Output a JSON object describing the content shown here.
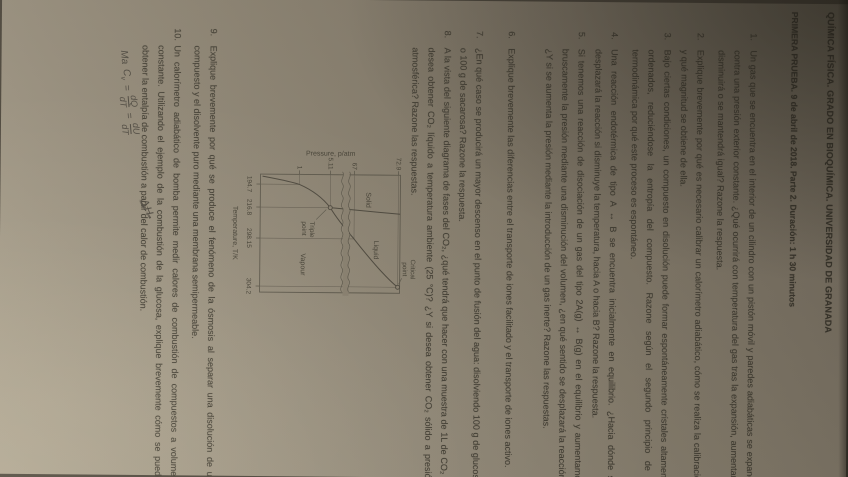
{
  "document": {
    "title": "QUÍMICA FÍSICA. GRADO EN BIOQUÍMICA. UNIVERSIDAD DE GRANADA",
    "subtitle": "PRIMERA PRUEBA. 9 de abril de 2018. Parte 2. Duración: 1 h 30 minutos"
  },
  "questions": [
    {
      "number": "1.",
      "text": "Un gas que se encuentra en el interior de un cilindro con un pistón móvil y paredes adiabáticas se expande contra una presión exterior constante. ¿Qué ocurrirá con temperatura del gas tras la expansión, aumentará, disminuirá o se mantendrá igual? Razone la respuesta."
    },
    {
      "number": "2.",
      "text": "Explique brevemente por qué es necesario calibrar un calorímetro adiabático, cómo se realiza la calibración y qué magnitud se obtiene de ella."
    },
    {
      "number": "3.",
      "text": "Bajo ciertas condiciones, un compuesto en disolución puede formar espontáneamente cristales altamente ordenados, reduciéndose la entropía del compuesto. Razone según el segundo principio de la termodinámica por qué este proceso es espontáneo."
    },
    {
      "number": "4.",
      "text": "Una reacción endotérmica de tipo A ↔ B se encuentra inicialmente en equilibrio. ¿Hacia dónde se desplazará la reacción si disminuye la temperatura, hacia A o hacia B? Razone la respuesta."
    },
    {
      "number": "5.",
      "text": "Si tenemos una reacción de disociación de un gas del tipo 2A(g) ↔ B(g) en el equilibrio y aumentamos bruscamente la presión mediante una disminución del volumen, ¿en qué sentido se desplazará la reacción? ¿Y si se aumenta la presión mediante la introducción de un gas inerte? Razone las respuestas."
    },
    {
      "number": "6.",
      "text": "Explique brevemente las diferencias entre el transporte de iones facilitado y el transporte de iones activo."
    },
    {
      "number": "7.",
      "text": "¿En qué caso se producirá un mayor descenso en el punto de fusión del agua: disolviendo 100 g de glucosa o 100 g de sacarosa? Razone la respuesta."
    },
    {
      "number": "8.",
      "text": "A la vista del siguiente diagrama de fases del CO₂, ¿qué tendrá que hacer con una muestra de 1L de CO₂ si desea obtener CO₂ líquido a temperatura ambiente (25 °C)? ¿Y si desea obtener CO₂ sólido a presión atmosférica? Razone las respuestas."
    },
    {
      "number": "9.",
      "text": "Explique brevemente por qué se produce el fenómeno de la ósmosis al separar una disolución de un compuesto y el disolvente puro mediante una membrana semipermeable."
    },
    {
      "number": "10.",
      "text": "Un calorímetro adiabático de bomba permite medir calores de combustión de compuestos a volumen constante. Utilizando el ejemplo de la combustión de la glucosa, explique brevemente cómo se puede obtener la entalpía de combustión a partir del calor de combustión."
    }
  ],
  "figure": {
    "labels": {
      "pressure_axis": "Pressure, p/atm",
      "temperature_axis": "Temperature, T/K",
      "solid": "Solid",
      "liquid": "Liquid",
      "vapour": "Vapour",
      "triple_1": "Triple",
      "triple_2": "point",
      "critical_1": "Critical",
      "critical_2": "point"
    },
    "p_ticks": [
      "72.9",
      "67",
      "5.11",
      "1"
    ],
    "t_ticks": [
      "194.7",
      "216.8",
      "298.15",
      "304.2"
    ],
    "chart_data": {
      "type": "line",
      "title": "Phase diagram of CO2 (CO₂)",
      "xlabel": "Temperature, T/K",
      "ylabel": "Pressure, p/atm",
      "x_ticks": [
        194.7,
        216.8,
        298.15,
        304.2
      ],
      "y_ticks": [
        1,
        5.11,
        67,
        72.9
      ],
      "y_axis_break_between": [
        5.11,
        67
      ],
      "regions": [
        "Solid",
        "Liquid",
        "Vapour"
      ],
      "special_points": [
        {
          "name": "Triple point",
          "T_K": 216.8,
          "p_atm": 5.11
        },
        {
          "name": "Critical point",
          "T_K": 304.2,
          "p_atm": 72.9
        },
        {
          "name": "Sublimation at 1 atm",
          "T_K": 194.7,
          "p_atm": 1
        },
        {
          "name": "Liquid–vapour at room temperature",
          "T_K": 298.15,
          "p_atm": 67
        }
      ],
      "series": [
        {
          "name": "solid–vapour boundary",
          "points": [
            [
              194.7,
              1
            ],
            [
              216.8,
              5.11
            ]
          ]
        },
        {
          "name": "solid–liquid boundary",
          "points": [
            [
              216.8,
              5.11
            ],
            [
              218,
              74
            ]
          ]
        },
        {
          "name": "liquid–vapour boundary",
          "points": [
            [
              216.8,
              5.11
            ],
            [
              298.15,
              67
            ],
            [
              304.2,
              72.9
            ]
          ]
        }
      ],
      "grid": false,
      "legend": false
    }
  },
  "handwriting": {
    "prefix": "Ma",
    "symbol_main": "C",
    "symbol_sub": "v",
    "equals_1": "=",
    "frac1_num": "dQ",
    "frac1_den": "dT",
    "equals_2": "=",
    "frac2_num": "dU",
    "frac2_den": "dT",
    "scribble": "ΔH"
  }
}
